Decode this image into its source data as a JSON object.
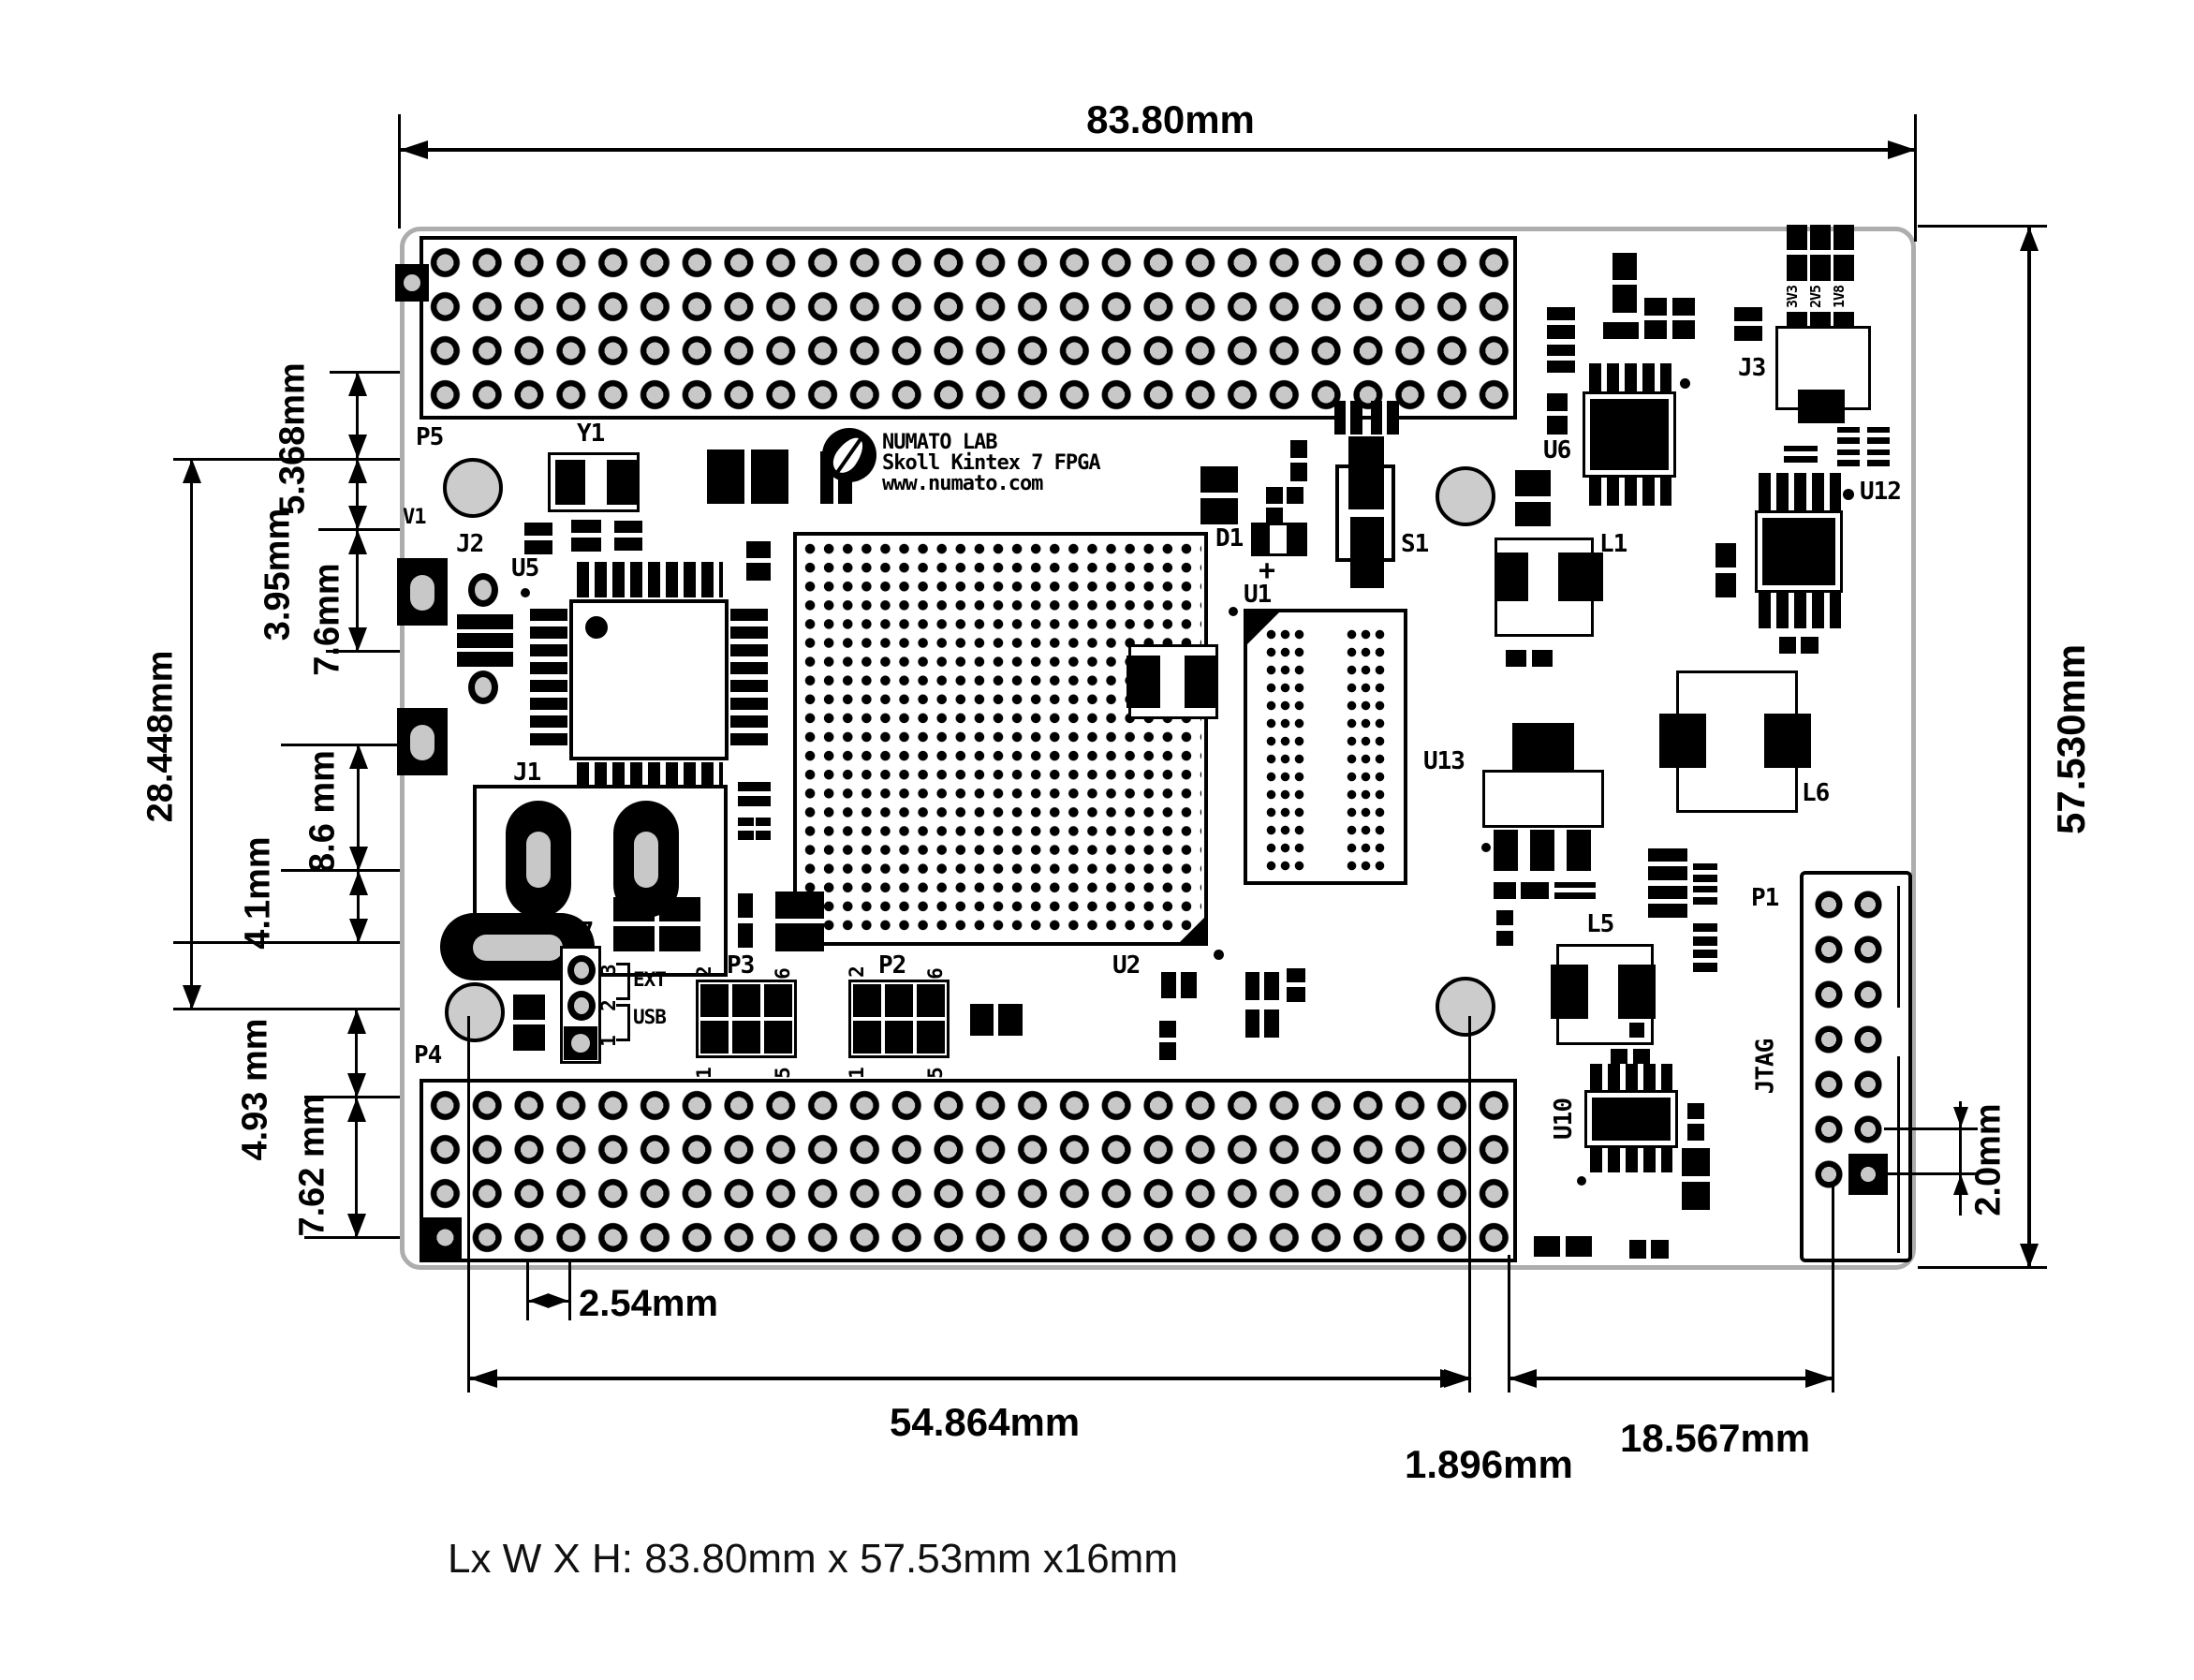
{
  "caption": "Lx W X H: 83.80mm x 57.53mm x16mm",
  "logo": {
    "line1": "NUMATO LAB",
    "line2": "Skoll Kintex 7 FPGA",
    "line3": "www.numato.com"
  },
  "dims": {
    "width": "83.80mm",
    "height": "57.530mm",
    "left1": "5.368mm",
    "left2": "3.95mm",
    "left3": "7.6mm",
    "left4": "28.448mm",
    "left5": "8.6 mm",
    "left6": "4.1mm",
    "left7": "4.93 mm",
    "left8": "7.62 mm",
    "pitch": "2.54mm",
    "bottom1": "54.864mm",
    "bottom2": "1.896mm",
    "bottom3": "18.567mm",
    "right1": "2.0mm"
  },
  "refs": {
    "p5": "P5",
    "p4": "P4",
    "y1": "Y1",
    "v1": "V1",
    "j2": "J2",
    "u5": "U5",
    "j1": "J1",
    "p7": "P7",
    "p3": "P3",
    "p2": "P2",
    "u2": "U2",
    "u1": "U1",
    "d1": "D1",
    "plus": "+",
    "s1": "S1",
    "u6": "U6",
    "j3": "J3",
    "l1": "L1",
    "u12": "U12",
    "u13": "U13",
    "l5": "L5",
    "l6": "L6",
    "p1": "P1",
    "jtag": "JTAG",
    "u10": "U10"
  },
  "p7_pins": {
    "pin3": "3",
    "pin2": "2",
    "pin1": "1",
    "ext": "EXT",
    "usb": "USB"
  },
  "hdr_pins": {
    "n2": "2",
    "n6": "6",
    "n1": "1",
    "n5": "5"
  },
  "j3_rails": {
    "r1": "3V3",
    "r2": "2V5",
    "r3": "1V8"
  },
  "colors": {
    "silkscreen": "#000000",
    "hole_fill": "#c8c8c8",
    "board_outline": "#adadad"
  }
}
